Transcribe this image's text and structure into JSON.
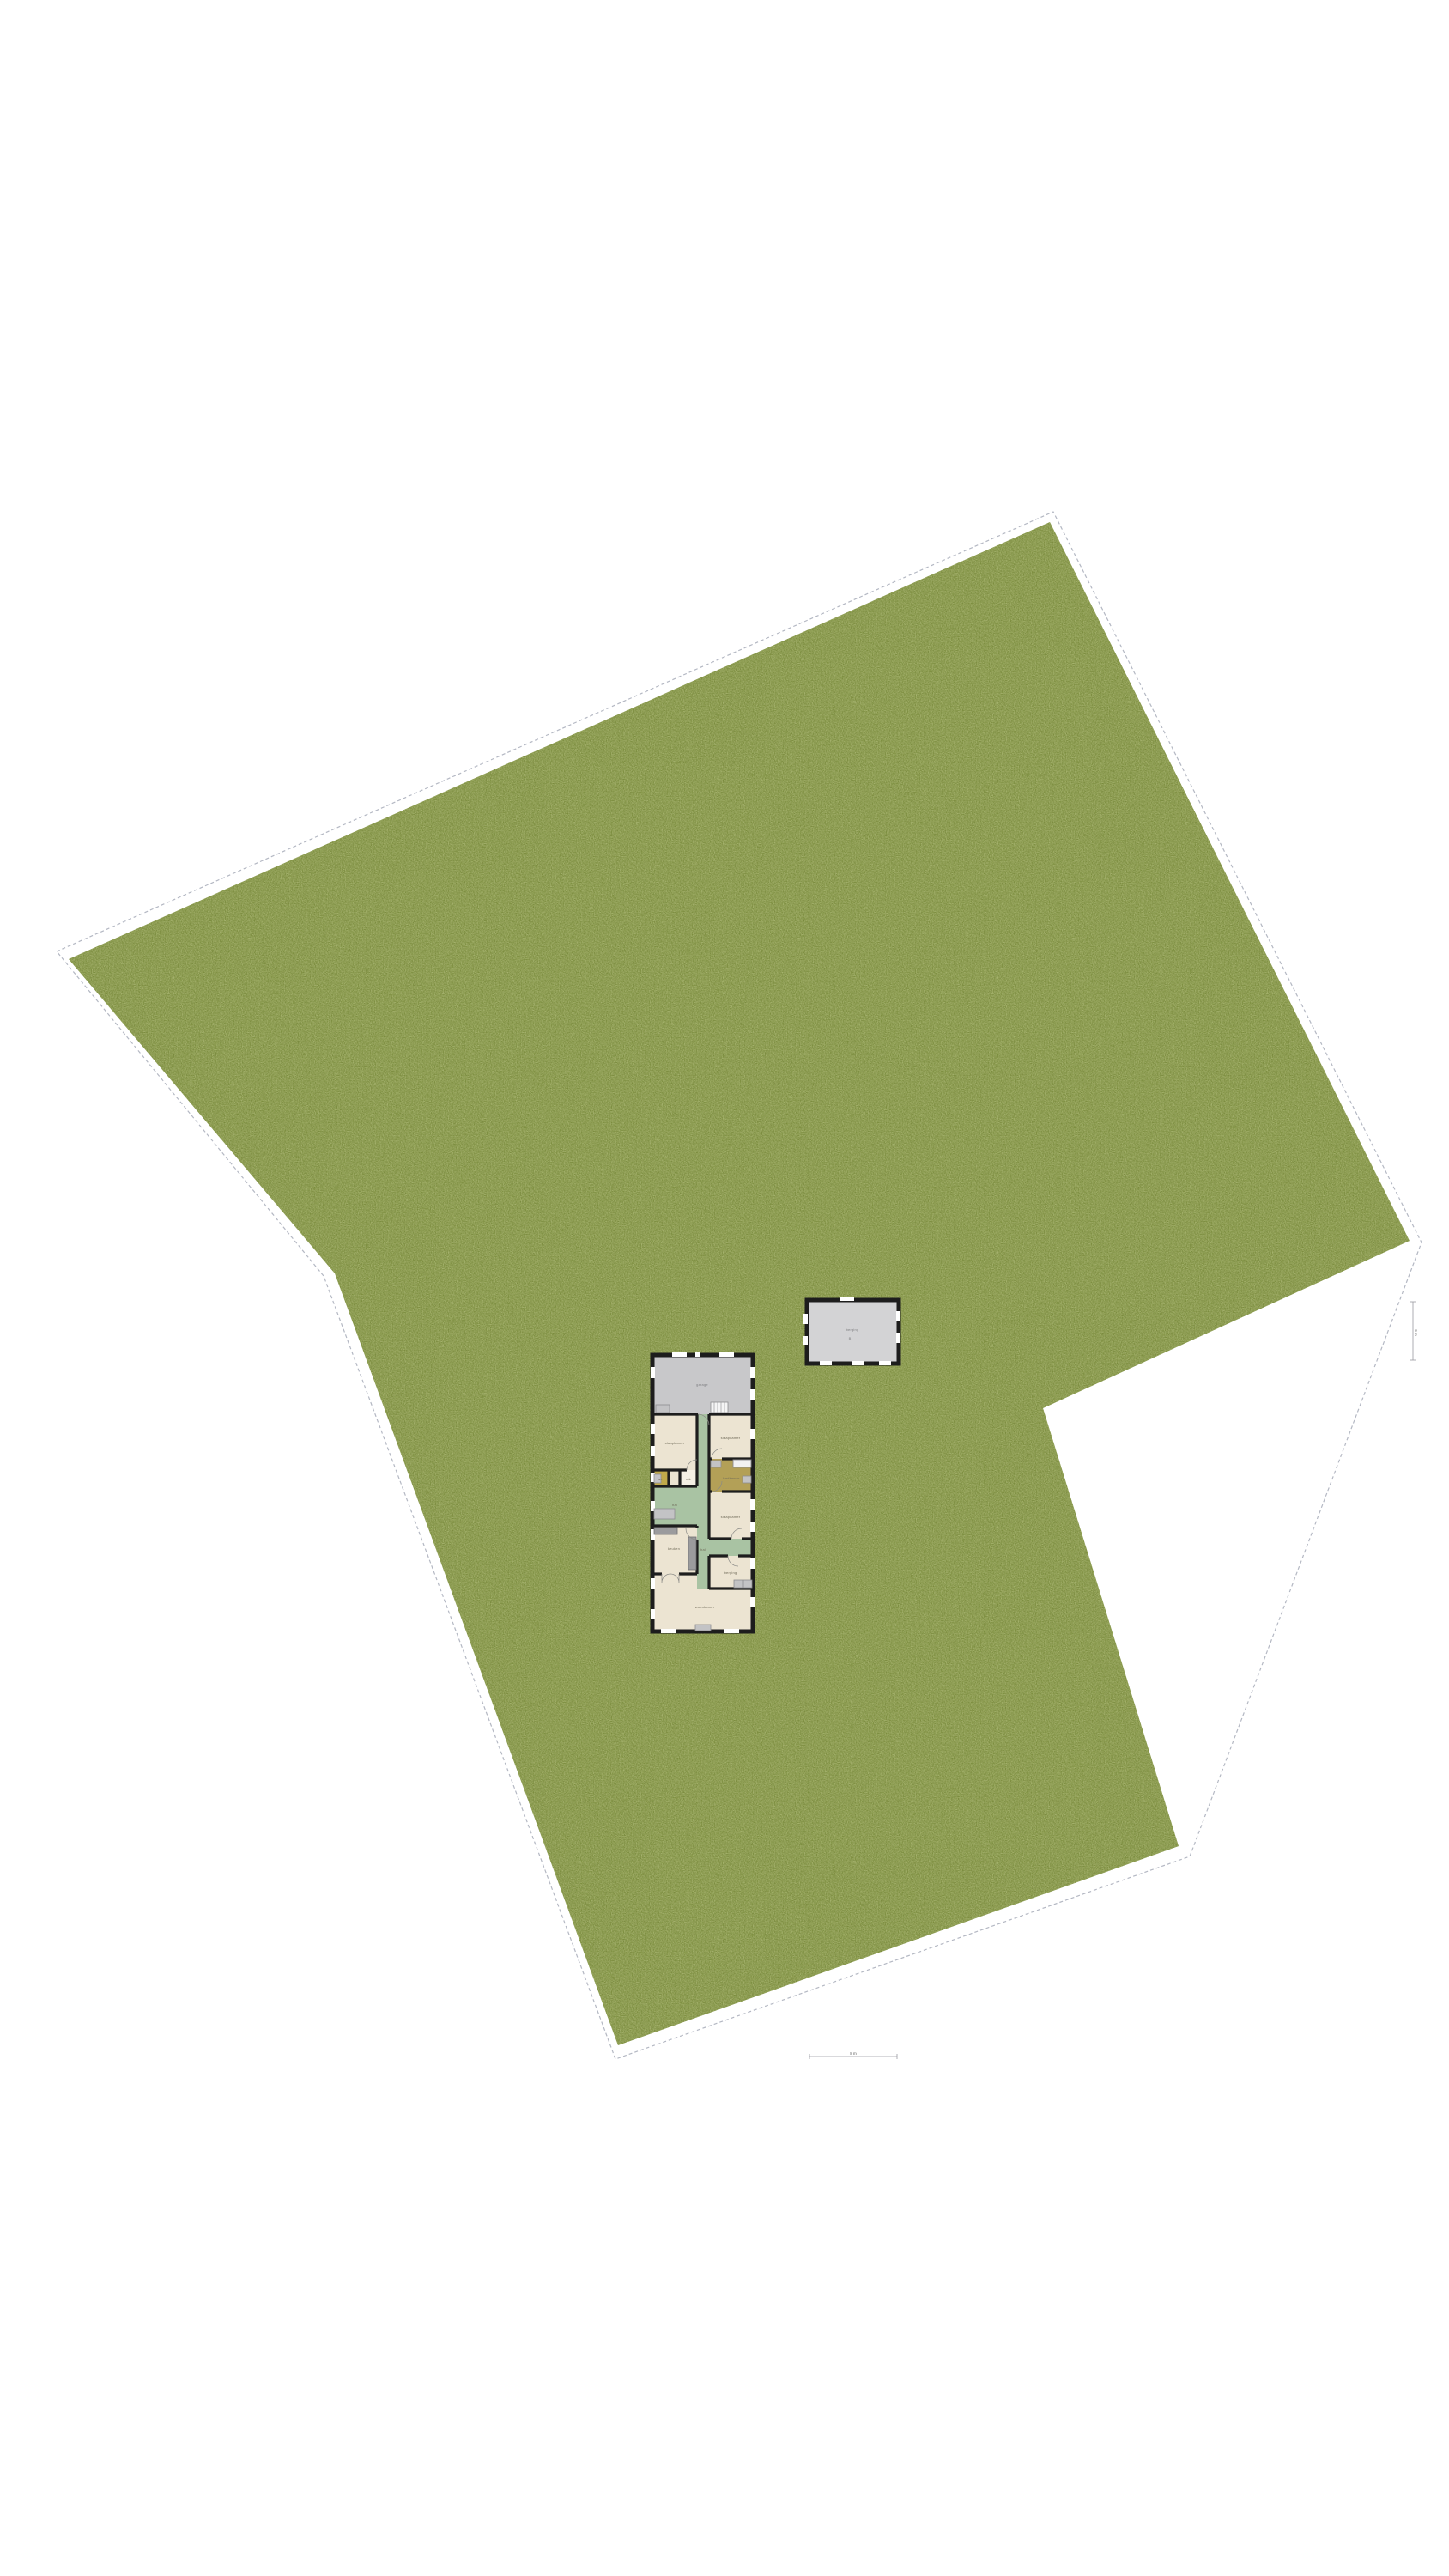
{
  "document": {
    "type": "site-plan",
    "background_color": "#ffffff"
  },
  "site": {
    "lawn_color": "#7d903e",
    "boundary_line_color": "#b4b8c3",
    "lawn_points": "80,1117 1223,608 1642,1445 1215,1640 1373,2150 720,2382 390,1483",
    "boundary_points": "66,1108 1227,596 1656,1447 1386,2162 717,2398 377,1486"
  },
  "house": {
    "wall_color": "#1d1d1d",
    "floor_color": "#ece4d2",
    "hall_color": "#a9c3a3",
    "garage_floor_color": "#c8c8ca",
    "bathroom_floor_color": "#b3a057",
    "wc_floor_color": "#c0a94a",
    "rooms": [
      {
        "label": "garage"
      },
      {
        "label": "slaapkamer"
      },
      {
        "label": "slaapkamer"
      },
      {
        "label": "badkamer"
      },
      {
        "label": "wc"
      },
      {
        "label": "mk"
      },
      {
        "label": "hal"
      },
      {
        "label": "slaapkamer"
      },
      {
        "label": "keuken"
      },
      {
        "label": "hal"
      },
      {
        "label": "berging"
      },
      {
        "label": "woonkamer"
      }
    ]
  },
  "shed": {
    "floor_color": "#d3d3d5",
    "label": "berging",
    "letter": "B"
  },
  "annotations": {
    "right_dimension_label": "6 m",
    "bottom_dimension_label": "8 m"
  }
}
